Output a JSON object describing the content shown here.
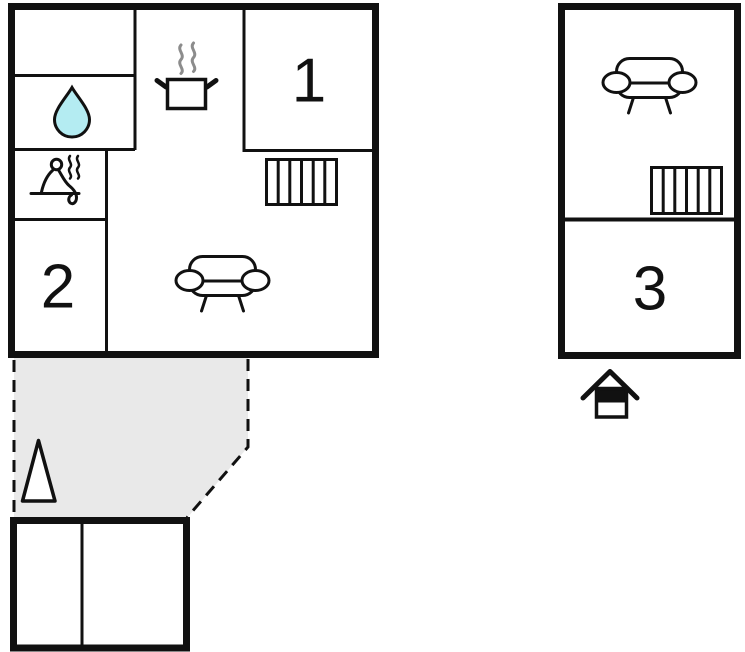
{
  "colors": {
    "wall": "#111111",
    "room_fill": "#ffffff",
    "water_drop_fill": "#b4ecf2",
    "terrace_fill": "#e9e9e9",
    "steam_gray": "#8c8c8c"
  },
  "ground_floor": {
    "rooms": [
      {
        "label": "1"
      },
      {
        "label": "2"
      }
    ],
    "icons": [
      "water-drop",
      "sauna",
      "cooking-pot",
      "radiator",
      "sofa"
    ],
    "terrace": {
      "outline": "dashed",
      "icons": [
        "tree"
      ]
    }
  },
  "annex": {
    "rooms": [
      {
        "label": "3"
      }
    ],
    "icons": [
      "sofa",
      "radiator",
      "house"
    ]
  }
}
